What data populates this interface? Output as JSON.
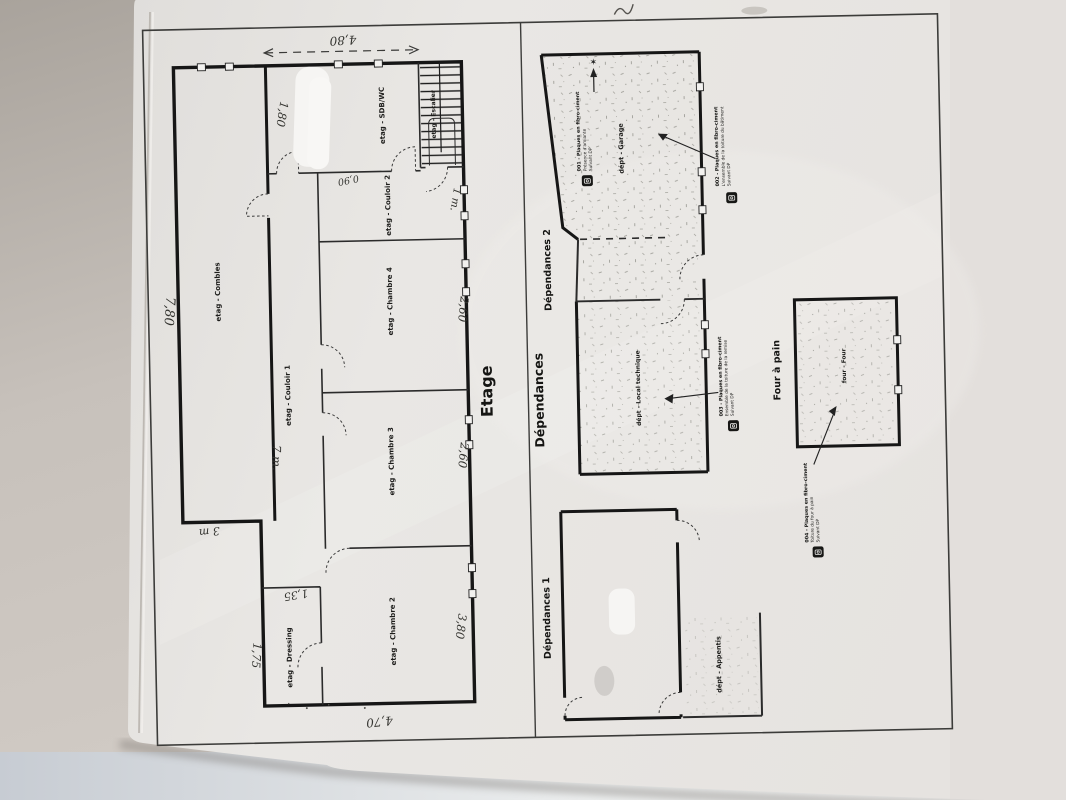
{
  "colors": {
    "paper": "#e8e6e3",
    "backdrop": "#c2bcb6",
    "desk": "#dfe3e8",
    "ink": "#1d1d1b",
    "pencil": "#33332f"
  },
  "etage": {
    "title": "Etage",
    "rooms": [
      "etag - Combles",
      "etag - Couloir 1",
      "etag - Chambre 4",
      "etag - Chambre 3",
      "etag - Chambre 2",
      "etag - Dressing",
      "etag - SDB/WC",
      "etag - Couloir 2",
      "etag - Escalier"
    ],
    "dimensions": [
      "4,80",
      "1,80",
      "7,80",
      "7 m.",
      "3 m",
      "1,75",
      "1,35",
      "3,80",
      "4,70",
      "2,60",
      "2,60",
      "0,90",
      "1 m."
    ]
  },
  "dependances": {
    "title": "Dépendances",
    "sections": {
      "dep2": "Dépendances 2",
      "dep1": "Dépendances 1",
      "four": "Four à pain"
    },
    "rooms": {
      "garage": "dépt - Garage",
      "local_technique": "dépt - Local technique",
      "appentis": "dépt - Appentis",
      "four": "four - Four"
    },
    "annotations": [
      {
        "title": "001 - Plaques en fibro-ciment",
        "line2": "Présence d'amiante",
        "line3": "Suivant DP"
      },
      {
        "title": "002 - Plaques en fibro-ciment",
        "line2": "L'ensemble de la toiture du bâtiment",
        "line3": "Suivant DP"
      },
      {
        "title": "003 - Plaques en fibro-ciment",
        "line2": "Ensemble de la toiture de la remise",
        "line3": "Suivant DP"
      },
      {
        "title": "004 - Plaques en fibro-ciment",
        "line2": "Toiture du four à pain",
        "line3": "Suivant DP"
      }
    ]
  },
  "icons": {
    "north_star": "✶"
  }
}
